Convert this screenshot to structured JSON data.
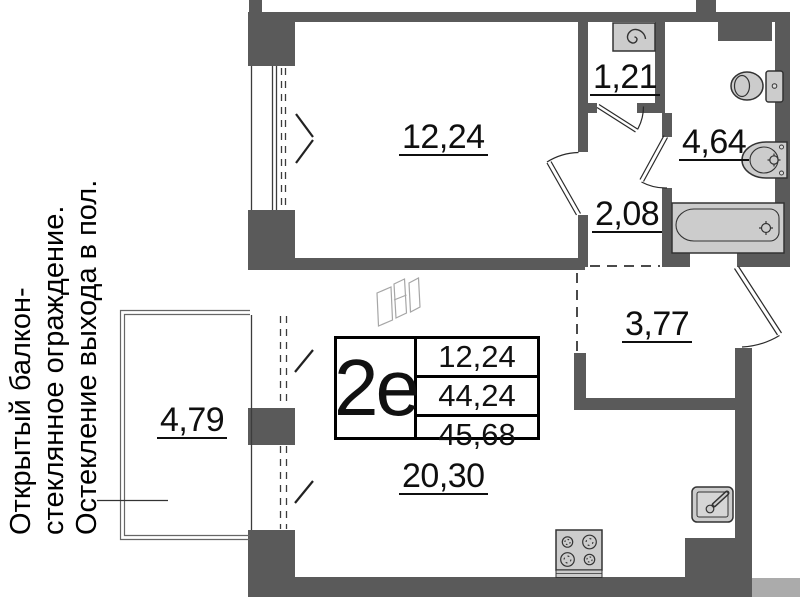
{
  "plan": {
    "annotation_lines": [
      "Открытый балкон-",
      "стеклянное ограждение.",
      "Остекление выхода в пол."
    ],
    "summary_table": {
      "unit_label": "2е",
      "values": [
        "12,24",
        "44,24",
        "45,68"
      ]
    },
    "rooms": [
      {
        "name": "bedroom",
        "area": "12,24"
      },
      {
        "name": "storage",
        "area": "1,21"
      },
      {
        "name": "bathroom",
        "area": "4,64"
      },
      {
        "name": "hall",
        "area": "2,08"
      },
      {
        "name": "entry-hall",
        "area": "3,77"
      },
      {
        "name": "living-kitchen",
        "area": "20,30"
      },
      {
        "name": "balcony",
        "area": "4,79"
      }
    ],
    "icons": [
      "washing-machine-icon",
      "toilet-icon",
      "bath-sink-icon",
      "bathtub-icon",
      "kitchen-sink-icon",
      "stove-icon",
      "wardrobe-sketch-icon"
    ],
    "colors": {
      "wall": "#5a5a5a",
      "neighbor_wall": "#ababab",
      "fixture_fill": "#cccccc",
      "fixture_stroke": "#333333",
      "text": "#0f0f0f",
      "background": "#ffffff"
    }
  }
}
